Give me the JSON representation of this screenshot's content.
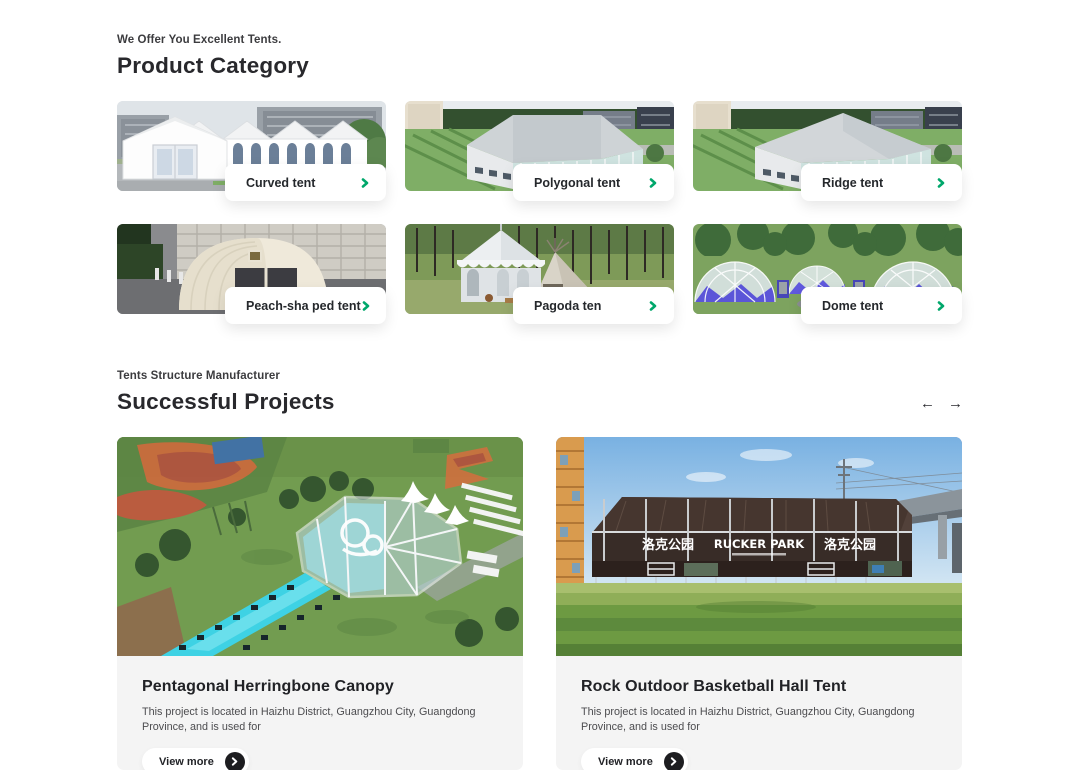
{
  "accent_color": "#00a76b",
  "product_category": {
    "eyebrow": "We Offer You Excellent Tents.",
    "title": "Product Category",
    "items": [
      {
        "label": "Curved tent"
      },
      {
        "label": "Polygonal tent"
      },
      {
        "label": "Ridge tent"
      },
      {
        "label": "Peach-sha ped tent"
      },
      {
        "label": "Pagoda ten"
      },
      {
        "label": "Dome tent"
      }
    ]
  },
  "projects": {
    "eyebrow": "Tents Structure Manufacturer",
    "title": "Successful Projects",
    "prev_arrow": "←",
    "next_arrow": "→",
    "cards": [
      {
        "title": "Pentagonal Herringbone Canopy",
        "description": "This project is located in Haizhu District, Guangzhou City, Guangdong Province, and is used for",
        "cta": "View more"
      },
      {
        "title": "Rock Outdoor Basketball Hall Tent",
        "description": "This project is located in Haizhu District, Guangzhou City, Guangdong Province, and is used for",
        "cta": "View more",
        "signage": [
          "洛克公园",
          "RUCKER PARK",
          "洛克公园"
        ]
      }
    ]
  }
}
